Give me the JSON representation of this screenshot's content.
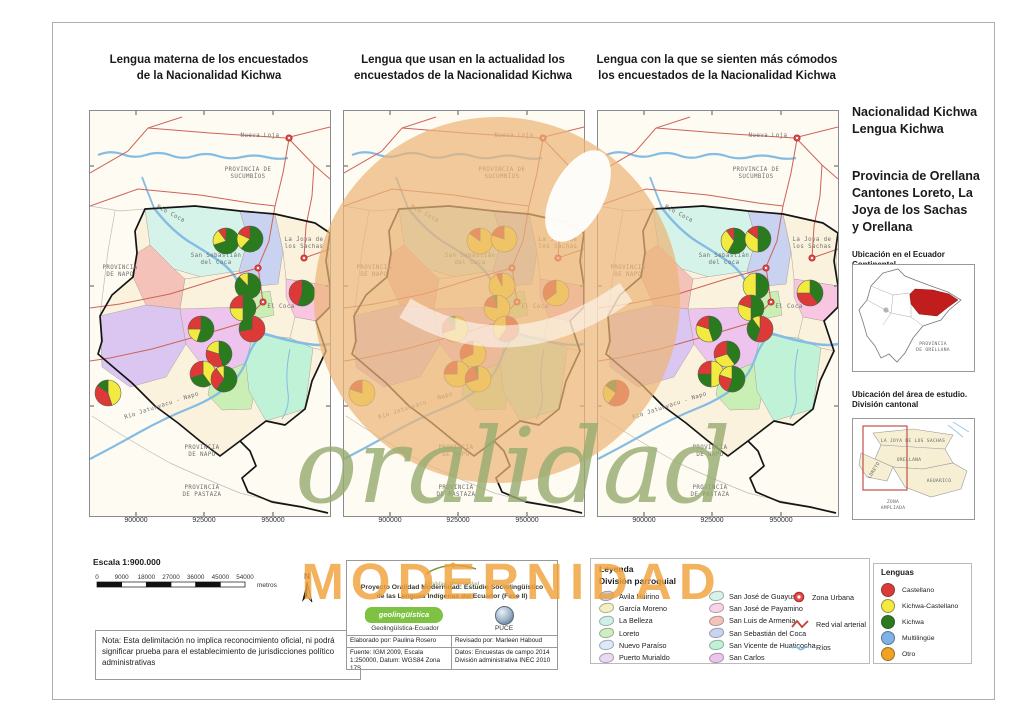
{
  "colors": {
    "castellano": "#DD3A37",
    "kichwa_castellano": "#F2EA3E",
    "kichwa": "#2A7A1E",
    "multilingue": "#7EB3E8",
    "otro": "#F2A21F",
    "road": "#CE6257",
    "river": "#85BCE4",
    "urban": "#E85050"
  },
  "titles": {
    "map1": "Lengua materna de los encuestados\nde la Nacionalidad Kichwa",
    "map2": "Lengua que usan en la actualidad los\nencuestados de la Nacionalidad Kichwa",
    "map3": "Lengua con la que se sienten más cómodos\nlos encuestados de la Nacionalidad Kichwa"
  },
  "sidebar": {
    "heading": "Nacionalidad Kichwa\nLengua Kichwa",
    "subheading": "Provincia de Orellana\nCantones Loreto, La\nJoya de los Sachas\ny Orellana",
    "inset1_title": "Ubicación en el Ecuador Continental",
    "inset1_province": "PROVINCIA\nDE ORELLANA",
    "inset2_title": "Ubicación del área de estudio.\nDivisión cantonal",
    "inset2_labels": {
      "sachas": "LA JOYA DE LOS SACHAS",
      "orellana": "ORELLANA",
      "loreto": "LORETO",
      "aguarico": "AGUARICO",
      "zona": "ZONA\nAMPLIADA"
    }
  },
  "scalebar": {
    "title": "Escala 1:900.000",
    "ticks": [
      "0",
      "9000",
      "18000",
      "27000",
      "36000",
      "45000",
      "54000"
    ],
    "unit": "metros",
    "north": "N"
  },
  "note": "Nota: Esta delimitación no implica reconocimiento oficial, ni podrá significar prueba para el establecimiento de jurisdicciones político administrativas",
  "credits": {
    "logo_script": "Oralidad Modernidad",
    "project": "Proyecto Oralidad Modernidad: Estudio Sociolingüístico\nde las Lenguas Indígenas del Ecuador  (Fase II)",
    "geo_logo": "geolingüística",
    "geo_logo_sub": "ecuador",
    "geo_caption": "Geolingüística-Ecuador",
    "puce_caption": "PUCE",
    "elaborado": "Elaborado por: Paulina Rosero",
    "revisado": "Revisado por: Marleen Haboud",
    "fuente": "Fuente: IGM 2009, Escala 1:250000, Datum: WGS84 Zona 17S",
    "datos": "Datos: Encuestas de campo 2014 División administrativa INEC 2010"
  },
  "legend": {
    "title": "Leyenda",
    "subtitle": "División parroquial",
    "col1": [
      {
        "label": "Avila Huirino",
        "color": "#C9D4F2"
      },
      {
        "label": "García Moreno",
        "color": "#F2EFC2"
      },
      {
        "label": "La Belleza",
        "color": "#CFF0E6"
      },
      {
        "label": "Loreto",
        "color": "#CDEFC0"
      },
      {
        "label": "Nuevo Paraíso",
        "color": "#DCE9F8"
      },
      {
        "label": "Puerto Murialdo",
        "color": "#EBD8F2"
      }
    ],
    "col2": [
      {
        "label": "San José de Guayusa",
        "color": "#D5F3E9"
      },
      {
        "label": "San José de Payamino",
        "color": "#F8D2E8"
      },
      {
        "label": "San Luis de Armenia",
        "color": "#F5C2B9"
      },
      {
        "label": "San Sebastián del Coca",
        "color": "#C9D2F1"
      },
      {
        "label": "San Vicente de Huaticocha",
        "color": "#C0F2D8"
      },
      {
        "label": "San Carlos",
        "color": "#EDC4ED"
      }
    ],
    "symbols": {
      "zona_urbana": "Zona Urbana",
      "red_vial": "Red vial arterial",
      "rios": "Ríos"
    }
  },
  "lenguas": {
    "title": "Lenguas",
    "items": [
      {
        "label": "Castellano",
        "key": "castellano"
      },
      {
        "label": "Kichwa-Castellano",
        "key": "kichwa_castellano"
      },
      {
        "label": "Kichwa",
        "key": "kichwa"
      },
      {
        "label": "Multilingüe",
        "key": "multilingue"
      },
      {
        "label": "Otro",
        "key": "otro"
      }
    ]
  },
  "maps": {
    "axis_x": [
      "900000",
      "925000",
      "950000"
    ],
    "axis_x_pos": [
      46,
      114,
      183
    ],
    "urban_points": [
      [
        199,
        27
      ],
      [
        214,
        147
      ],
      [
        168,
        157
      ],
      [
        173,
        191
      ]
    ],
    "geo_labels": [
      {
        "t": "Nueva Loja",
        "x": 170,
        "y": 26
      },
      {
        "t": "PROVINCIA DE\nSUCUMBÍOS",
        "x": 158,
        "y": 60
      },
      {
        "t": "Río Coca",
        "x": 80,
        "y": 104,
        "r": 28
      },
      {
        "t": "PROVINCIA\nDE NAPO",
        "x": 30,
        "y": 158
      },
      {
        "t": "La Joya de\nlos Sachas",
        "x": 214,
        "y": 130
      },
      {
        "t": "San Sebastián\ndel Coca",
        "x": 126,
        "y": 146
      },
      {
        "t": "El Coca",
        "x": 191,
        "y": 197
      },
      {
        "t": "Río Jatunyacu - Napo",
        "x": 72,
        "y": 296,
        "r": -18
      },
      {
        "t": "PROVINCIA\nDE NAPO",
        "x": 112,
        "y": 338
      },
      {
        "t": "PROVINCIA\nDE PASTAZA",
        "x": 112,
        "y": 378
      }
    ],
    "panels": [
      {
        "name": "lengua-materna",
        "pies": [
          {
            "x": 136,
            "y": 130,
            "s": [
              [
                "kichwa",
                0.7
              ],
              [
                "kichwa_castellano",
                0.2
              ],
              [
                "castellano",
                0.1
              ]
            ]
          },
          {
            "x": 160,
            "y": 128,
            "s": [
              [
                "kichwa",
                0.62
              ],
              [
                "kichwa_castellano",
                0.2
              ],
              [
                "castellano",
                0.18
              ]
            ]
          },
          {
            "x": 158,
            "y": 175,
            "s": [
              [
                "kichwa",
                0.88
              ],
              [
                "kichwa_castellano",
                0.12
              ]
            ]
          },
          {
            "x": 212,
            "y": 182,
            "s": [
              [
                "kichwa",
                0.55
              ],
              [
                "castellano",
                0.45
              ]
            ]
          },
          {
            "x": 153,
            "y": 197,
            "s": [
              [
                "kichwa",
                0.5
              ],
              [
                "kichwa_castellano",
                0.25
              ],
              [
                "castellano",
                0.25
              ]
            ]
          },
          {
            "x": 162,
            "y": 218,
            "s": [
              [
                "castellano",
                0.72
              ],
              [
                "kichwa",
                0.28
              ]
            ]
          },
          {
            "x": 111,
            "y": 218,
            "s": [
              [
                "kichwa",
                0.55
              ],
              [
                "kichwa_castellano",
                0.2
              ],
              [
                "castellano",
                0.25
              ]
            ]
          },
          {
            "x": 129,
            "y": 243,
            "s": [
              [
                "kichwa",
                0.45
              ],
              [
                "castellano",
                0.35
              ],
              [
                "kichwa_castellano",
                0.2
              ]
            ]
          },
          {
            "x": 113,
            "y": 263,
            "s": [
              [
                "kichwa_castellano",
                0.4
              ],
              [
                "kichwa",
                0.3
              ],
              [
                "castellano",
                0.3
              ]
            ]
          },
          {
            "x": 134,
            "y": 268,
            "s": [
              [
                "kichwa",
                0.6
              ],
              [
                "castellano",
                0.3
              ],
              [
                "kichwa_castellano",
                0.1
              ]
            ]
          },
          {
            "x": 18,
            "y": 282,
            "s": [
              [
                "kichwa_castellano",
                0.45
              ],
              [
                "castellano",
                0.4
              ],
              [
                "kichwa",
                0.15
              ]
            ]
          }
        ]
      },
      {
        "name": "lengua-actual",
        "pies": [
          {
            "x": 136,
            "y": 130,
            "s": [
              [
                "kichwa_castellano",
                0.85
              ],
              [
                "castellano",
                0.15
              ]
            ]
          },
          {
            "x": 160,
            "y": 128,
            "s": [
              [
                "kichwa_castellano",
                0.8
              ],
              [
                "castellano",
                0.2
              ]
            ]
          },
          {
            "x": 158,
            "y": 175,
            "s": [
              [
                "kichwa_castellano",
                0.93
              ],
              [
                "castellano",
                0.07
              ]
            ]
          },
          {
            "x": 212,
            "y": 182,
            "s": [
              [
                "kichwa_castellano",
                0.65
              ],
              [
                "castellano",
                0.35
              ]
            ]
          },
          {
            "x": 153,
            "y": 197,
            "s": [
              [
                "kichwa_castellano",
                0.78
              ],
              [
                "castellano",
                0.17
              ],
              [
                "kichwa",
                0.05
              ]
            ]
          },
          {
            "x": 162,
            "y": 218,
            "s": [
              [
                "castellano",
                0.6
              ],
              [
                "kichwa_castellano",
                0.4
              ]
            ]
          },
          {
            "x": 111,
            "y": 218,
            "s": [
              [
                "kichwa_castellano",
                0.7
              ],
              [
                "castellano",
                0.2
              ],
              [
                "kichwa",
                0.1
              ]
            ]
          },
          {
            "x": 129,
            "y": 243,
            "s": [
              [
                "kichwa_castellano",
                0.68
              ],
              [
                "castellano",
                0.32
              ]
            ]
          },
          {
            "x": 113,
            "y": 263,
            "s": [
              [
                "kichwa_castellano",
                0.75
              ],
              [
                "castellano",
                0.25
              ]
            ]
          },
          {
            "x": 134,
            "y": 268,
            "s": [
              [
                "kichwa_castellano",
                0.7
              ],
              [
                "castellano",
                0.25
              ],
              [
                "kichwa",
                0.05
              ]
            ]
          },
          {
            "x": 18,
            "y": 282,
            "s": [
              [
                "kichwa_castellano",
                0.8
              ],
              [
                "castellano",
                0.2
              ]
            ]
          }
        ]
      },
      {
        "name": "lengua-comodos",
        "pies": [
          {
            "x": 136,
            "y": 130,
            "s": [
              [
                "kichwa",
                0.58
              ],
              [
                "kichwa_castellano",
                0.32
              ],
              [
                "castellano",
                0.1
              ]
            ]
          },
          {
            "x": 160,
            "y": 128,
            "s": [
              [
                "kichwa",
                0.5
              ],
              [
                "kichwa_castellano",
                0.35
              ],
              [
                "castellano",
                0.15
              ]
            ]
          },
          {
            "x": 158,
            "y": 175,
            "s": [
              [
                "kichwa",
                0.5
              ],
              [
                "kichwa_castellano",
                0.5
              ]
            ]
          },
          {
            "x": 212,
            "y": 182,
            "s": [
              [
                "kichwa",
                0.4
              ],
              [
                "castellano",
                0.35
              ],
              [
                "kichwa_castellano",
                0.25
              ]
            ]
          },
          {
            "x": 153,
            "y": 197,
            "s": [
              [
                "kichwa",
                0.5
              ],
              [
                "kichwa_castellano",
                0.3
              ],
              [
                "castellano",
                0.2
              ]
            ]
          },
          {
            "x": 162,
            "y": 218,
            "s": [
              [
                "castellano",
                0.55
              ],
              [
                "kichwa",
                0.35
              ],
              [
                "kichwa_castellano",
                0.1
              ]
            ]
          },
          {
            "x": 111,
            "y": 218,
            "s": [
              [
                "kichwa",
                0.45
              ],
              [
                "kichwa_castellano",
                0.35
              ],
              [
                "castellano",
                0.2
              ]
            ]
          },
          {
            "x": 129,
            "y": 243,
            "s": [
              [
                "kichwa",
                0.4
              ],
              [
                "kichwa_castellano",
                0.3
              ],
              [
                "castellano",
                0.3
              ]
            ]
          },
          {
            "x": 113,
            "y": 263,
            "s": [
              [
                "kichwa_castellano",
                0.5
              ],
              [
                "kichwa",
                0.25
              ],
              [
                "castellano",
                0.25
              ]
            ]
          },
          {
            "x": 134,
            "y": 268,
            "s": [
              [
                "kichwa",
                0.55
              ],
              [
                "castellano",
                0.25
              ],
              [
                "kichwa_castellano",
                0.2
              ]
            ]
          },
          {
            "x": 18,
            "y": 282,
            "s": [
              [
                "castellano",
                0.6
              ],
              [
                "kichwa_castellano",
                0.25
              ],
              [
                "kichwa",
                0.15
              ]
            ]
          }
        ]
      }
    ]
  },
  "watermark": {
    "word1": "oralidad",
    "word2": "MODERNIDAD"
  }
}
